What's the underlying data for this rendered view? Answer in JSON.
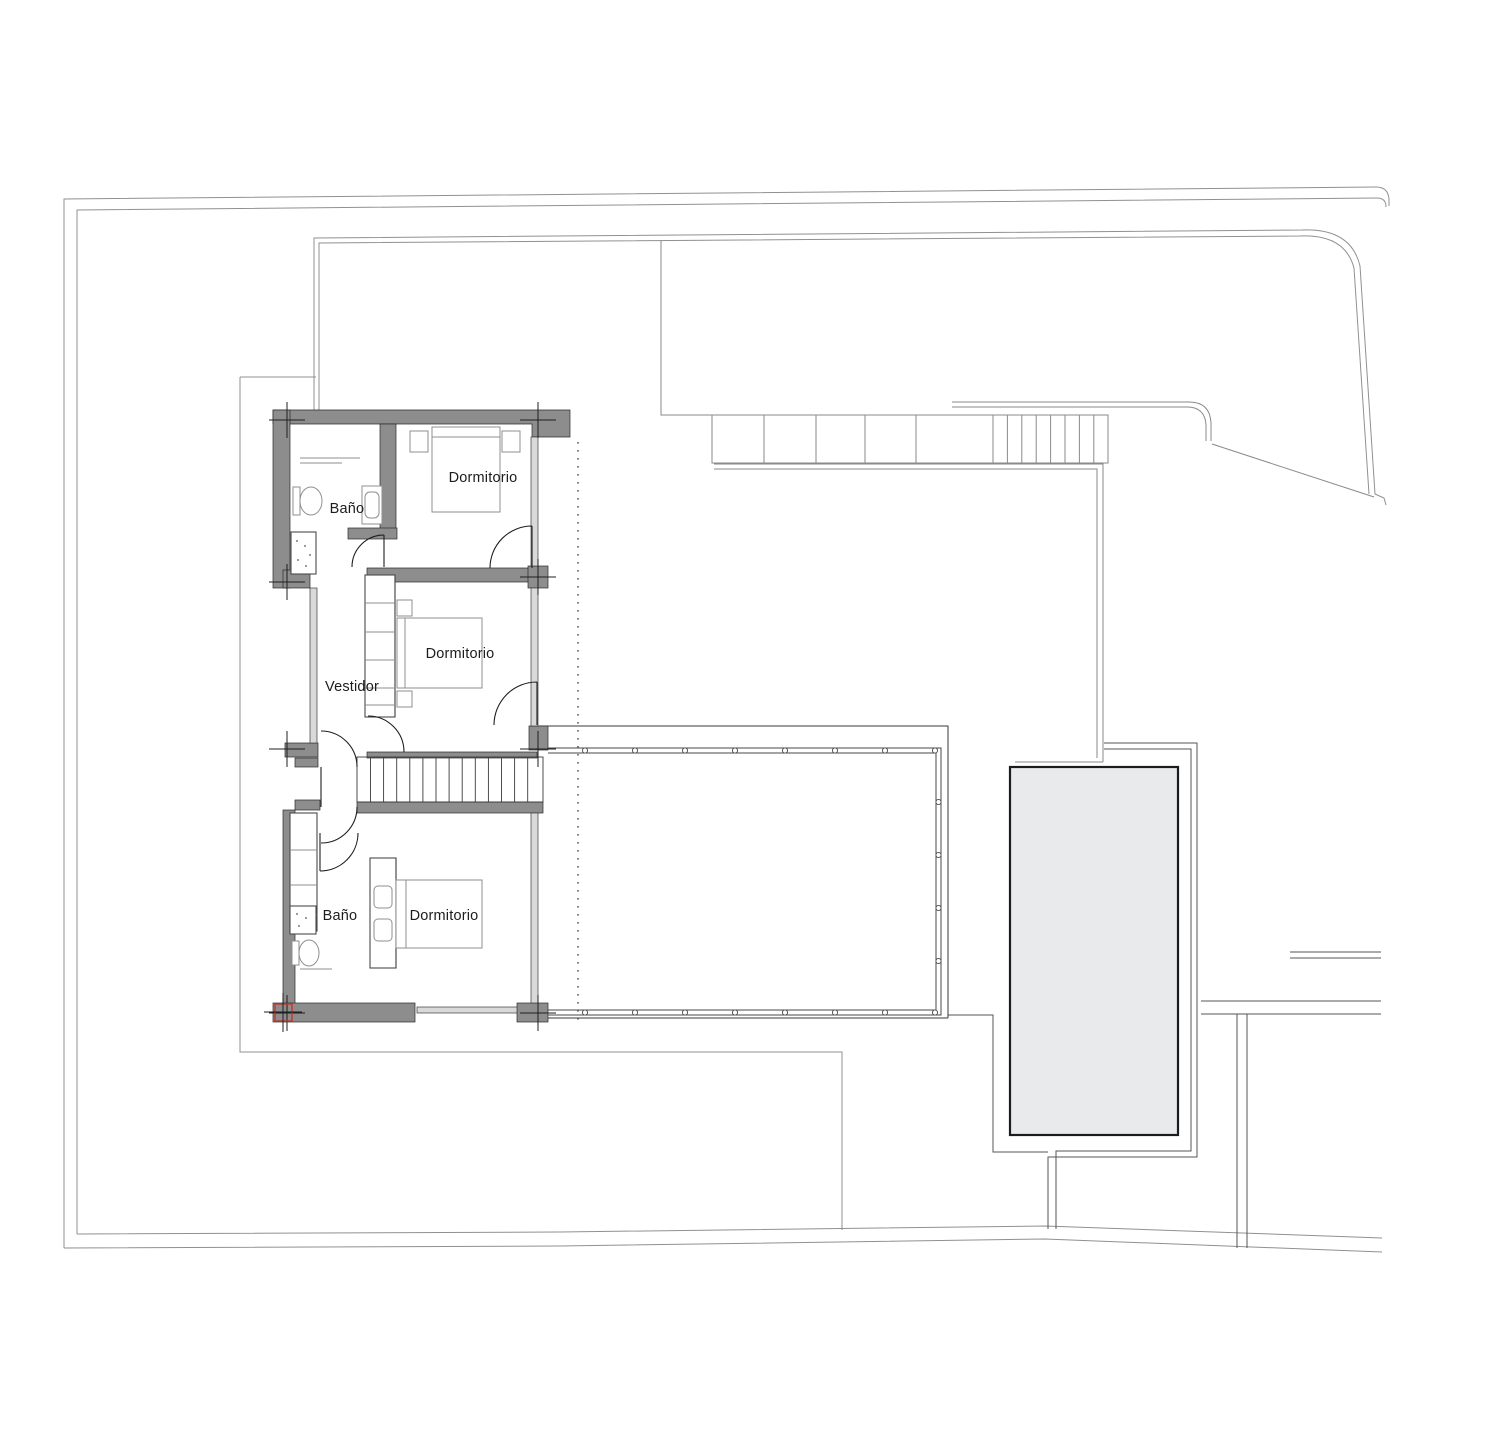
{
  "rooms": [
    {
      "id": "dormitorio-top",
      "label": "Dormitorio",
      "x": 483,
      "y": 482
    },
    {
      "id": "bano-top",
      "label": "Baño",
      "x": 347,
      "y": 513
    },
    {
      "id": "dormitorio-middle",
      "label": "Dormitorio",
      "x": 460,
      "y": 658
    },
    {
      "id": "vestidor",
      "label": "Vestidor",
      "x": 352,
      "y": 691
    },
    {
      "id": "bano-bottom",
      "label": "Baño",
      "x": 340,
      "y": 920
    },
    {
      "id": "dormitorio-bottom",
      "label": "Dormitorio",
      "x": 444,
      "y": 920
    }
  ],
  "colors": {
    "wall_gray": "#8d8d8d",
    "pool_fill": "#e8eaec",
    "glazing_gray": "#d9d9d9",
    "line_dark": "#1f1f1f",
    "site_line_gray": "#909090",
    "survey_marker_red": "#c0392b"
  }
}
